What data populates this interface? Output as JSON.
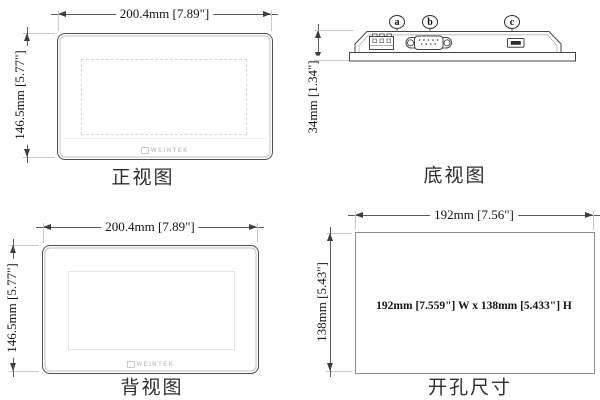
{
  "colors": {
    "outline": "#454545",
    "dimension_line": "#5a5a5a",
    "extension_line": "#c9c9c9",
    "logo_gray": "#c6c6c6"
  },
  "views": {
    "front": {
      "label": "正视图",
      "width_dim": "200.4mm [7.89\"]",
      "height_dim": "146.5mm [5.77\"]",
      "logo_text": "WEINTEK"
    },
    "bottom": {
      "label": "底视图",
      "height_dim": "34mm [1.34\"]",
      "port_a": "a",
      "port_b": "b",
      "port_c": "c"
    },
    "back": {
      "label": "背视图",
      "width_dim": "200.4mm [7.89\"]",
      "height_dim": "146.5mm [5.77\"]",
      "logo_text": "WEINTEK"
    },
    "cutout": {
      "label": "开孔尺寸",
      "width_dim": "192mm [7.56\"]",
      "height_dim": "138mm [5.43\"]",
      "center_text": "192mm [7.559\"] W x 138mm [5.433\"] H"
    }
  }
}
